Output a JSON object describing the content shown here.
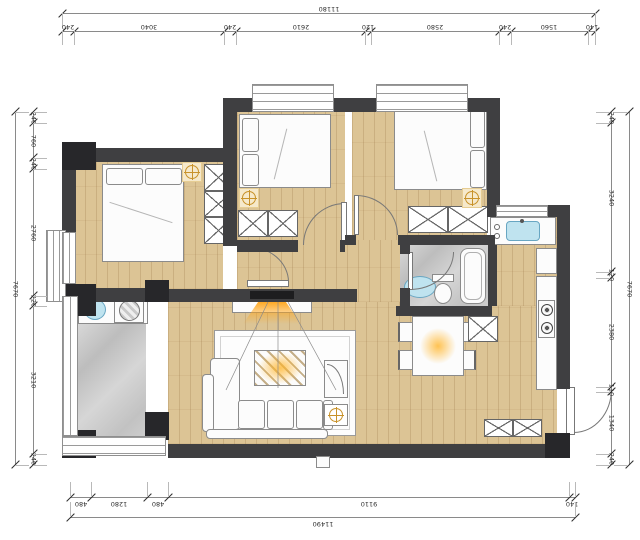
{
  "drawing_type": "apartment-floor-plan",
  "dimensions": {
    "top": {
      "total": "11180",
      "segments": [
        "240",
        "3040",
        "240",
        "2610",
        "120",
        "2580",
        "240",
        "1560",
        "140"
      ]
    },
    "bottom": {
      "total": "11490",
      "segments": [
        "480",
        "1280",
        "480",
        "9110",
        "140"
      ]
    },
    "left": {
      "total": "7670",
      "segments": [
        "240",
        "760",
        "240",
        "2760",
        "220",
        "3210",
        "240"
      ]
    },
    "right": {
      "total": "7670",
      "segments": [
        "240",
        "3240",
        "120",
        "2380",
        "110",
        "1340",
        "240"
      ]
    }
  },
  "colors": {
    "wall": "#3f3f41",
    "wood_floor": "#dcc495",
    "marble_floor": "#c9c9c9",
    "light_accent": "#c8922a",
    "water_fixture": "#bfe3ef"
  },
  "icons": [
    "ceiling-light-icon",
    "tv-beam-icon",
    "gas-hob-icon",
    "kitchen-sink-icon",
    "washing-machine-icon",
    "toilet-icon",
    "bathtub-icon",
    "wash-basin-icon",
    "bed-icon",
    "wardrobe-cross-icon",
    "dining-table-icon",
    "sofa-icon",
    "door-swing-icon",
    "window-icon",
    "shoe-cabinet-icon"
  ]
}
